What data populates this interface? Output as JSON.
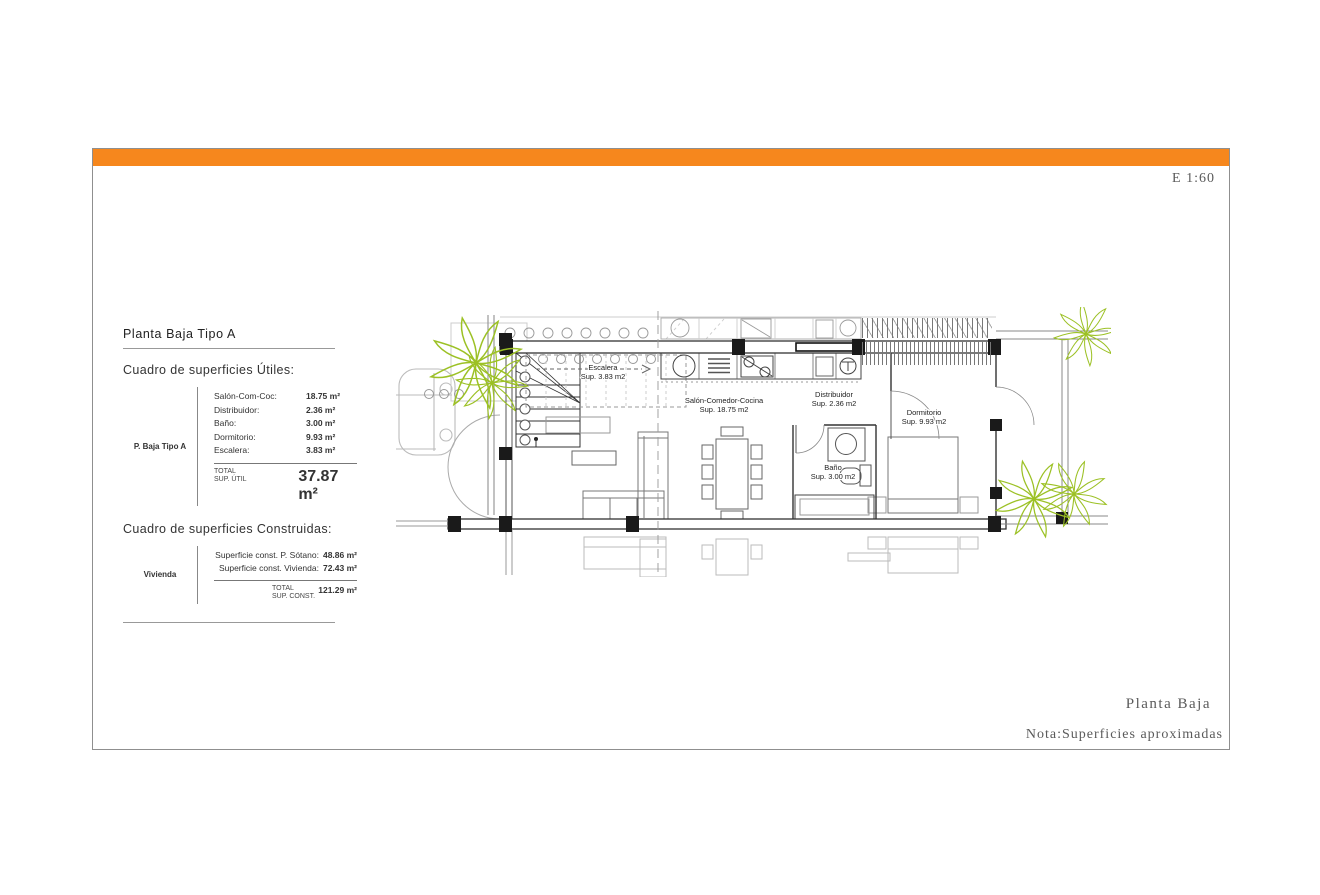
{
  "sheet": {
    "scale_label": "E 1:60",
    "caption": "Planta Baja",
    "note": "Nota:Superficies aproximadas",
    "accent_color": "#F6871D",
    "plant_color": "#9CC125"
  },
  "panel": {
    "title": "Planta Baja Tipo A",
    "useful": {
      "heading": "Cuadro de superficies Útiles:",
      "row_header": "P. Baja Tipo A",
      "rows": [
        {
          "label": "Salón-Com-Coc:",
          "value": "18.75 m²"
        },
        {
          "label": "Distribuidor:",
          "value": "2.36 m²"
        },
        {
          "label": "Baño:",
          "value": "3.00 m²"
        },
        {
          "label": "Dormitorio:",
          "value": "9.93 m²"
        },
        {
          "label": "Escalera:",
          "value": "3.83 m²"
        }
      ],
      "total_label_1": "TOTAL",
      "total_label_2": "SUP. ÚTIL",
      "total_value": "37.87 m²"
    },
    "built": {
      "heading": "Cuadro de superficies Construidas:",
      "row_header": "Vivienda",
      "rows": [
        {
          "label": "Superficie const. P. Sótano:",
          "value": "48.86 m²"
        },
        {
          "label": "Superficie const. Vivienda:",
          "value": "72.43 m²"
        }
      ],
      "total_label_1": "TOTAL",
      "total_label_2": "SUP. CONST.",
      "total_value": "121.29 m²"
    }
  },
  "plan": {
    "rooms": [
      {
        "name": "Escalera",
        "area": "Sup. 3.83 m2"
      },
      {
        "name": "Salón-Comedor-Cocina",
        "area": "Sup. 18.75 m2"
      },
      {
        "name": "Distribuidor",
        "area": "Sup. 2.36 m2"
      },
      {
        "name": "Dormitorio",
        "area": "Sup. 9.93 m2"
      },
      {
        "name": "Baño",
        "area": "Sup. 3.00 m2"
      }
    ]
  }
}
